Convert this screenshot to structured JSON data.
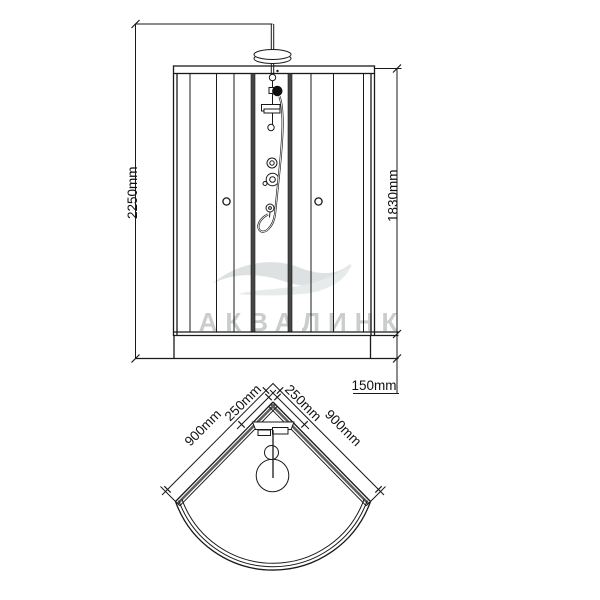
{
  "drawing": {
    "title": "shower-cabin-technical-drawing",
    "watermark": "АКВАЛИНК",
    "front_view": {
      "total_height": "2250mm",
      "cabin_height": "1830mm",
      "tray_height": "150mm"
    },
    "top_view": {
      "left_width": "900mm",
      "left_corner_offset": "250mm",
      "right_corner_offset": "250mm",
      "right_width": "900mm"
    },
    "colors": {
      "line": "#1a1a1a",
      "glass_panel_dark": "#454745",
      "wall_shading": "#5f5f5f",
      "watermark_gray": "#c9cdce",
      "wave_gray": "#dde1e2",
      "background": "#ffffff"
    }
  }
}
